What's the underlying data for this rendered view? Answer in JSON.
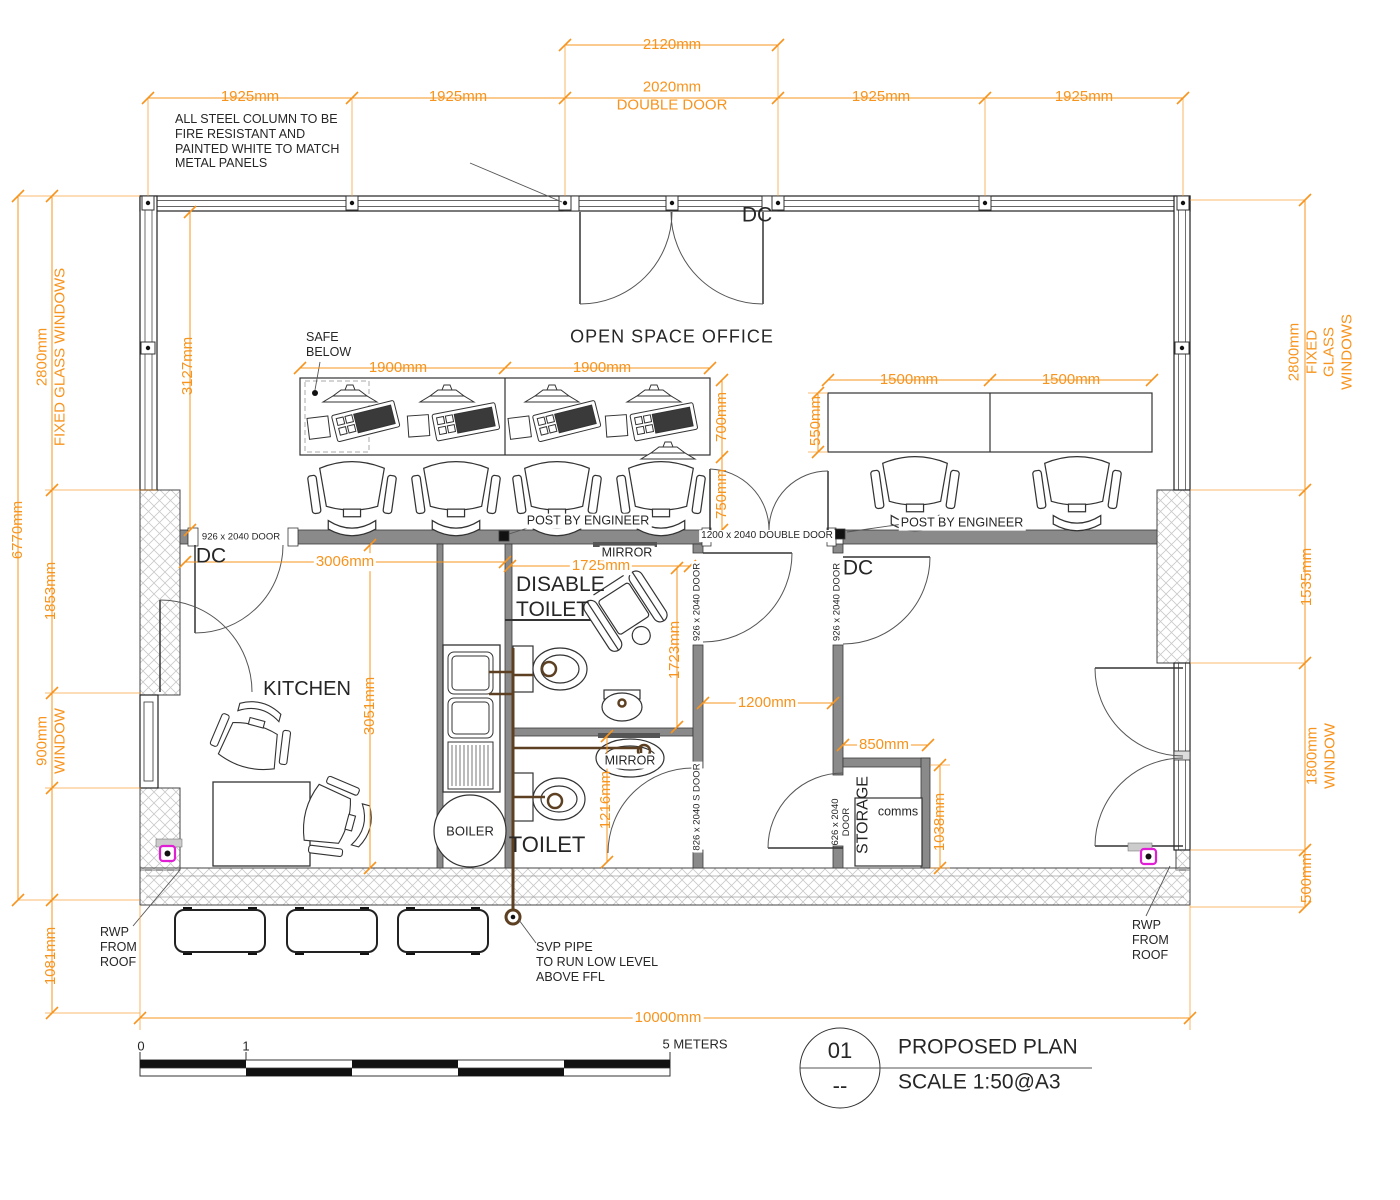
{
  "colors": {
    "dimension": "#F7941E",
    "ink": "#262626",
    "pipe": "#5D4022",
    "socket": "#E01FD5"
  },
  "drawing": {
    "title_block": {
      "number": "01",
      "revision": "--",
      "title": "PROPOSED PLAN",
      "scale": "SCALE 1:50@A3"
    },
    "scale_bar": {
      "zero": "0",
      "one": "1",
      "end": "5 METERS"
    }
  },
  "rooms": {
    "office": "OPEN SPACE OFFICE",
    "kitchen": "KITCHEN",
    "disable_toilet": "DISABLE\nTOILET",
    "toilet": "TOILET",
    "storage": "STORAGE",
    "comms": "comms",
    "boiler": "BOILER",
    "mirror_a": "MIRROR",
    "mirror_b": "MIRROR",
    "dc_top": "DC",
    "dc_kitchen": "DC",
    "dc_right": "DC"
  },
  "doors": {
    "top_double": "2020mm\nDOUBLE DOOR",
    "kitchen": "926 x 2040 DOOR",
    "corridor": "1200 x 2040 DOUBLE DOOR",
    "disable": "926 x 2040 DOOR",
    "right_room": "926 x 2040 DOOR",
    "toilet_s": "826 x 2040 S DOOR",
    "storage": "626 x 2040\nDOOR"
  },
  "notes": {
    "steel": "ALL STEEL COLUMN TO BE\nFIRE RESISTANT AND\nPAINTED WHITE TO MATCH\nMETAL PANELS",
    "safe": "SAFE\nBELOW",
    "post_a": "POST BY ENGINEER",
    "post_b": "POST BY ENGINEER",
    "svp": "SVP PIPE\nTO RUN LOW LEVEL\nABOVE FFL",
    "rwp_a": "RWP\nFROM\nROOF",
    "rwp_b": "RWP\nFROM\nROOF"
  },
  "dims": {
    "t2120": "2120mm",
    "t1925a": "1925mm",
    "t1925b": "1925mm",
    "t1925c": "1925mm",
    "t1925d": "1925mm",
    "l2800": "2800mm\nFIXED GLASS WINDOWS",
    "l6770": "6770mm",
    "l1853": "1853mm",
    "l900": "900mm\nWINDOW",
    "l1081": "1081mm",
    "r2800": "2800mm\nFIXED GLASS WINDOWS",
    "r1535": "1535mm",
    "r1800": "1800mm\nWINDOW",
    "r500": "500mm",
    "d1900a": "1900mm",
    "d1900b": "1900mm",
    "d700": "700mm",
    "d750": "750mm",
    "d550": "550mm",
    "d1500a": "1500mm",
    "d1500b": "1500mm",
    "v3127": "3127mm",
    "k3006": "3006mm",
    "k3051": "3051mm",
    "dt1725": "1725mm",
    "dt1723": "1723mm",
    "c1200": "1200mm",
    "t1216": "1216mm",
    "s850": "850mm",
    "s1038": "1038mm",
    "total": "10000mm"
  }
}
